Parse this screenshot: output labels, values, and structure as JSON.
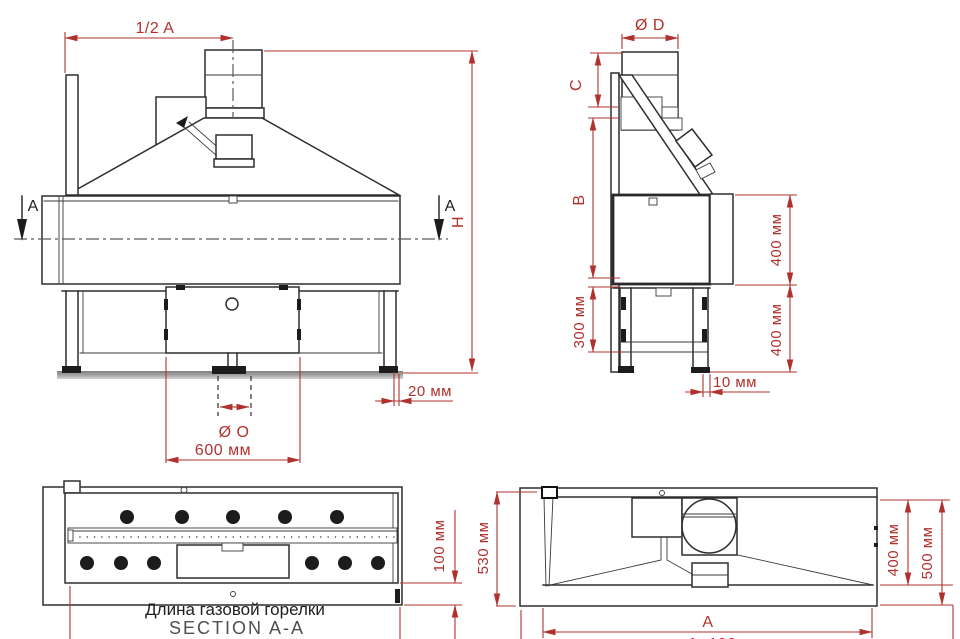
{
  "colors": {
    "dimension": "#b0312e",
    "outline": "#2e2e2e",
    "caption": "#1f1f1f",
    "caption_secondary": "#4f4f4f",
    "background": "#ffffff"
  },
  "front": {
    "dim_half_width": "1/2 A",
    "section_marker_left": "A",
    "section_marker_right": "A",
    "dim_height": "H",
    "dim_wall_gap": "20 мм",
    "dim_pipe_diameter": "Ø O",
    "dim_burner_box_width": "600 мм"
  },
  "side": {
    "dim_flue_diameter": "Ø D",
    "dim_top": "C",
    "dim_middle": "B",
    "dim_plinth": "300 мм",
    "dim_firebox_depth": "400 мм",
    "dim_stand_depth": "400 мм",
    "dim_back_offset": "10 мм"
  },
  "section": {
    "dim_depth": "100 мм",
    "caption_line1": "Длина газовой горелки",
    "caption_line2": "SECTION A-A"
  },
  "plan": {
    "dim_depth_overall": "530 мм",
    "dim_depth_hood": "400 мм",
    "dim_depth_body": "500 мм",
    "dim_width": "A",
    "dim_width_overall": "A+100"
  }
}
